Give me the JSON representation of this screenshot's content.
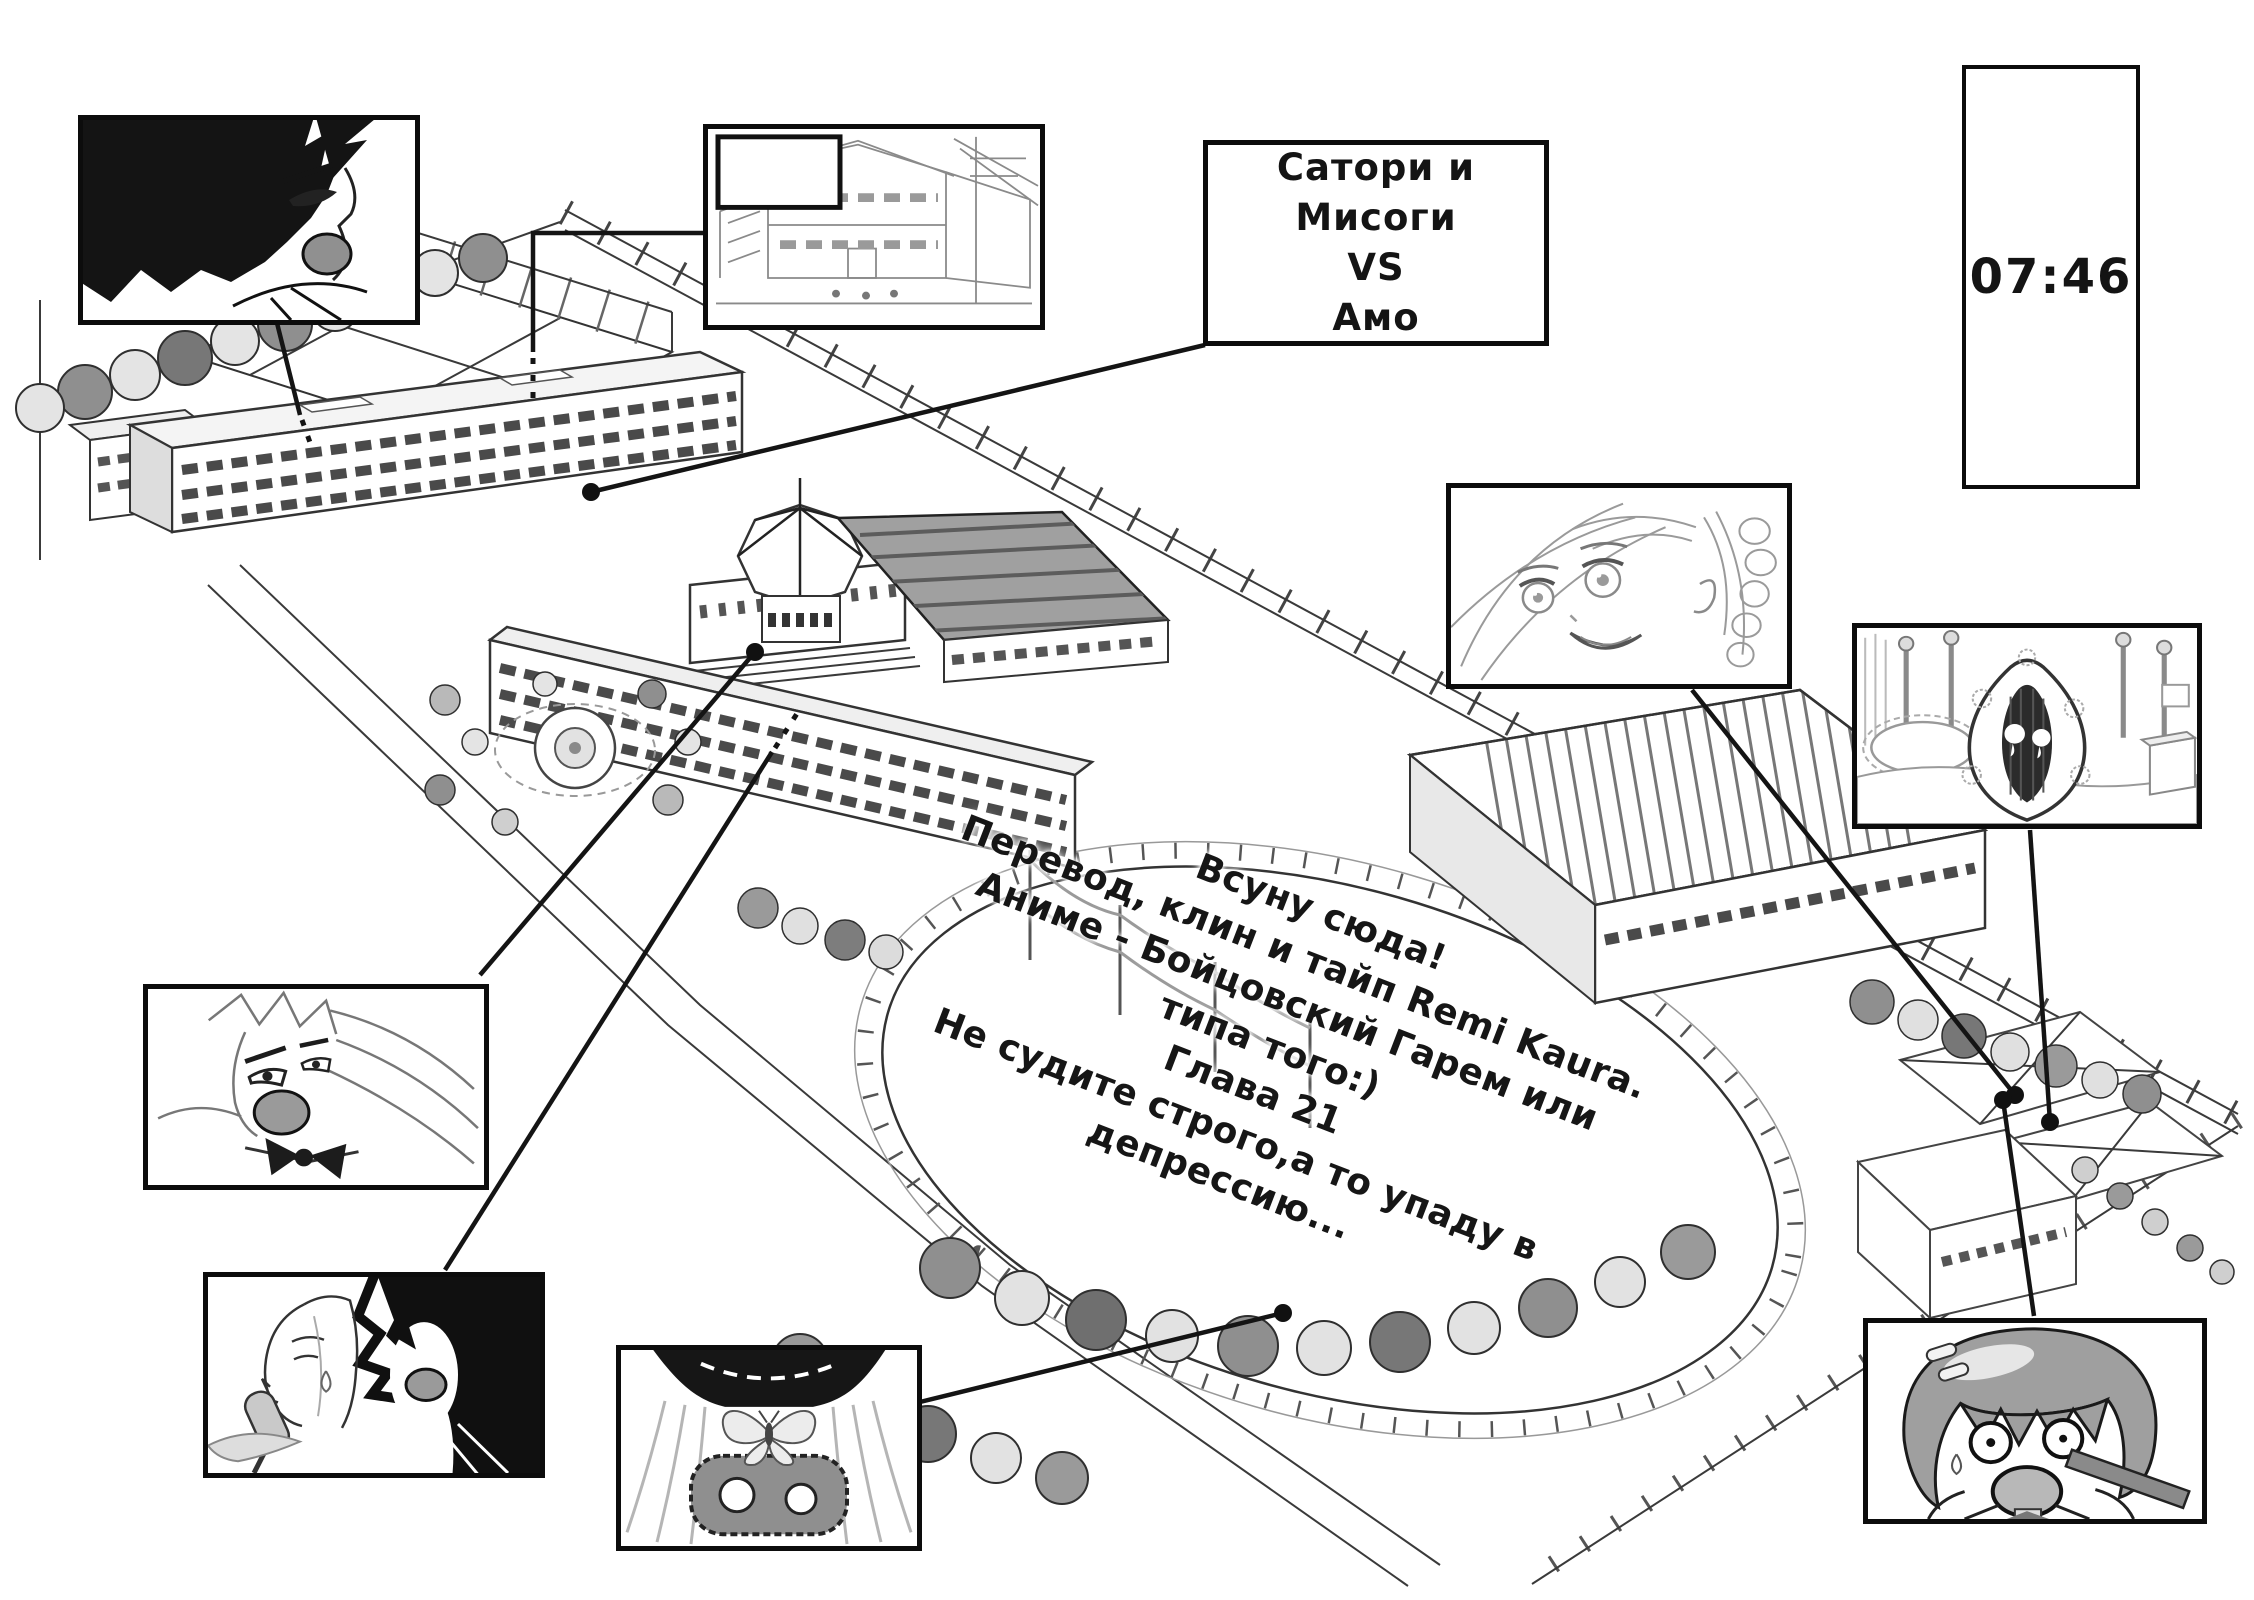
{
  "clock": {
    "time": "07:46"
  },
  "battle_box": {
    "line1": "Сатори и Мисоги",
    "line2": "VS",
    "line3": "Амо"
  },
  "speech_bubble_text": "",
  "credits": {
    "lines": [
      "Всуну сюда!",
      "Перевод, клин и тайп Remi Kaura.",
      "Аниме - Бойцовский Гарем или",
      "типа того:)",
      "Глава 21",
      "Не судите строго,а то упаду в",
      "депрессию..."
    ]
  },
  "colors": {
    "ink": "#141414",
    "paper": "#ffffff",
    "shade_gray": "#9f9f9f",
    "light_gray": "#d9d9d9"
  },
  "panel_names": [
    "boy-shouting-panel",
    "street-building-panel",
    "battle-caption-box",
    "clock-time-box",
    "braided-girl-panel",
    "ghost-under-blanket-panel",
    "angry-blonde-girl-panel",
    "popsicle-pair-panel",
    "butterfly-mask-girl-panel",
    "shocked-bob-girl-panel"
  ]
}
